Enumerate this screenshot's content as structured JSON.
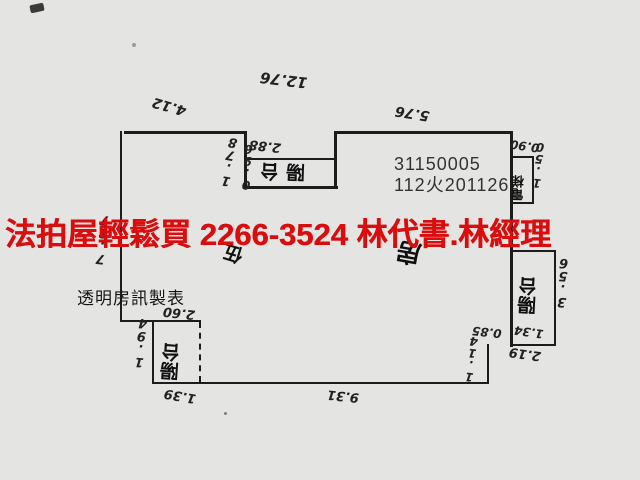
{
  "overlay": {
    "ad_text": "法拍屋輕鬆買  2266-3524  林代書.林經理",
    "ad_color": "#d90d0d",
    "watermark": "透明房訊製表"
  },
  "document": {
    "case_number": "31150005",
    "reference": "112火201126"
  },
  "plan": {
    "floor_label": "伍",
    "main_room_label": "房",
    "rooms": {
      "top_balcony": "陽台",
      "left_balcony": "陽台",
      "right_balcony": "陽台",
      "elevator": "電梯"
    },
    "dimensions": {
      "total_width": "12.76",
      "right_wing_top": "5.76",
      "left_wing_top": "4.12",
      "top_balcony_width": "2.88",
      "top_step": "1.78",
      "top_balcony_depth": "0.96",
      "left_height": "7.87",
      "elevator_top": "0.90",
      "elevator_side": "1.50",
      "right_balcony_height": "3.56",
      "right_balcony_width": "1.34",
      "right_inner": "0.85",
      "bottom_step_width": "2.19",
      "bottom_step_height": "1.14",
      "bottom_width": "9.31",
      "left_balcony_bottom": "1.39",
      "left_balcony_width": "2.60",
      "left_balcony_height": "1.94"
    }
  }
}
